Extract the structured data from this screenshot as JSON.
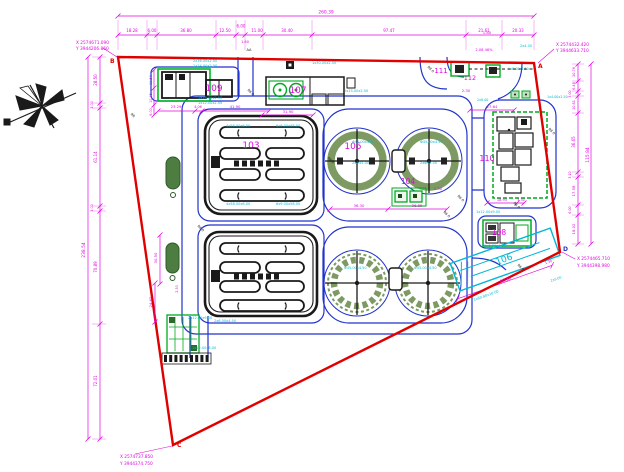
{
  "drawing_type": "wastewater treatment plant site plan (CAD)",
  "boundary": {
    "color": "#e00000",
    "corners": [
      {
        "id": "B",
        "x": "X 2574671.090",
        "y": "Y 3944206.860"
      },
      {
        "id": "A",
        "x": "X 2574432.420",
        "y": "Y 3944633.710"
      },
      {
        "id": "D",
        "x": "X 2574465.710",
        "y": "Y 3944398.980"
      },
      {
        "id": "C",
        "x": "X 2574737.850",
        "y": "Y 3944374.750"
      }
    ]
  },
  "dimension_chains": {
    "top": {
      "total": "260.39",
      "segments": [
        "18.28",
        "6.00",
        "36.80",
        "12.50",
        "6.00",
        "11.00",
        "30.40",
        "97.47",
        "21.61",
        "20.33"
      ]
    },
    "left": {
      "total": "238.54",
      "segments": [
        "28.50",
        "3.00",
        "61.14",
        "3.00",
        "70.89",
        "72.01"
      ]
    },
    "right": {
      "total": "115.84",
      "segments": [
        "10.76",
        "6.48",
        "3.00",
        "10.81",
        "36.65",
        "3.10",
        "17.58",
        "6.00",
        "18.02"
      ]
    }
  },
  "structures": [
    {
      "number": "103",
      "shape": "aeration-basin"
    },
    {
      "number": "104",
      "shape": "distribution-box"
    },
    {
      "number": "105",
      "shape": "circular-tank-pair"
    },
    {
      "number": "106",
      "shape": "inclined-structure"
    },
    {
      "number": "107",
      "shape": "building-with-blowers"
    },
    {
      "number": "108",
      "shape": "small-building"
    },
    {
      "number": "109",
      "shape": "building"
    },
    {
      "number": "110",
      "shape": "building"
    },
    {
      "number": "111",
      "shape": "gate-structure"
    },
    {
      "number": "112",
      "shape": "gate-structure"
    }
  ],
  "colors": {
    "boundary": "#e00000",
    "dimension": "#e206e2",
    "road": "#2133cc",
    "equipment_tag": "#00b8d4",
    "structure_green": "#00aa22",
    "tank_ring": "#7d9a63"
  },
  "annotations": [
    {
      "t": "109",
      "x": 214,
      "y": 91,
      "c": "m",
      "s": 9,
      "n": "building-label-109"
    },
    {
      "t": "107",
      "x": 298,
      "y": 93,
      "c": "m",
      "s": 9,
      "n": "building-label-107"
    },
    {
      "t": "103",
      "x": 251,
      "y": 148,
      "c": "m",
      "s": 9,
      "n": "building-label-103"
    },
    {
      "t": "105",
      "x": 353,
      "y": 149,
      "c": "m",
      "s": 9,
      "n": "building-label-105"
    },
    {
      "t": "104",
      "x": 408,
      "y": 184,
      "c": "m",
      "s": 7.5,
      "n": "building-label-104"
    },
    {
      "t": "110",
      "x": 487,
      "y": 161,
      "c": "m",
      "s": 8,
      "n": "building-label-110"
    },
    {
      "t": "111",
      "x": 441,
      "y": 73,
      "c": "m",
      "s": 7,
      "n": "building-label-111"
    },
    {
      "t": "112",
      "x": 470,
      "y": 80,
      "c": "m",
      "s": 6.5,
      "n": "building-label-112"
    },
    {
      "t": "108",
      "x": 499,
      "y": 235,
      "c": "m",
      "s": 7.5,
      "n": "building-label-108"
    },
    {
      "t": "106",
      "x": 505,
      "y": 262,
      "c": "c",
      "s": 9,
      "r": -19.5,
      "n": "building-label-106"
    },
    {
      "t": "260.39",
      "x": 326,
      "y": 13.5,
      "s": 4.4
    },
    {
      "t": "18.28",
      "x": 132,
      "y": 32
    },
    {
      "t": "6.00",
      "x": 152,
      "y": 32
    },
    {
      "t": "36.80",
      "x": 186,
      "y": 32
    },
    {
      "t": "12.50",
      "x": 225,
      "y": 32
    },
    {
      "t": "6.00",
      "x": 241,
      "y": 27.5
    },
    {
      "t": "11.00",
      "x": 257,
      "y": 32
    },
    {
      "t": "30.40",
      "x": 287,
      "y": 32
    },
    {
      "t": "97.47",
      "x": 389,
      "y": 32
    },
    {
      "t": "21.61",
      "x": 484,
      "y": 32
    },
    {
      "t": "20.33",
      "x": 518,
      "y": 32
    },
    {
      "t": "238.54",
      "x": 85,
      "y": 250,
      "r": -90,
      "s": 4.4
    },
    {
      "t": "28.50",
      "x": 97,
      "y": 80,
      "r": -90
    },
    {
      "t": "3.00",
      "x": 93,
      "y": 105,
      "r": -90,
      "s": 3.4
    },
    {
      "t": "61.14",
      "x": 97,
      "y": 157,
      "r": -90
    },
    {
      "t": "3.00",
      "x": 93,
      "y": 208,
      "r": -90,
      "s": 3.4
    },
    {
      "t": "70.89",
      "x": 97,
      "y": 267,
      "r": -90
    },
    {
      "t": "72.01",
      "x": 97,
      "y": 381,
      "r": -90
    },
    {
      "t": "115.84",
      "x": 589,
      "y": 155,
      "r": -90,
      "s": 4.4
    },
    {
      "t": "10.76",
      "x": 575,
      "y": 72,
      "r": -90,
      "s": 3.5
    },
    {
      "t": "6.48",
      "x": 575,
      "y": 86,
      "r": -90,
      "s": 3.5
    },
    {
      "t": "3.00",
      "x": 571,
      "y": 94,
      "r": -90,
      "s": 3.2
    },
    {
      "t": "10.81",
      "x": 575,
      "y": 105,
      "r": -90,
      "s": 3.5
    },
    {
      "t": "36.65",
      "x": 575,
      "y": 142,
      "r": -90
    },
    {
      "t": "3.10",
      "x": 571,
      "y": 175,
      "r": -90,
      "s": 3.2
    },
    {
      "t": "17.58",
      "x": 575,
      "y": 191,
      "r": -90,
      "s": 3.8
    },
    {
      "t": "6.00",
      "x": 571,
      "y": 210,
      "r": -90,
      "s": 3.2
    },
    {
      "t": "18.02",
      "x": 575,
      "y": 229,
      "r": -90,
      "s": 3.8
    },
    {
      "t": "23.29",
      "x": 176,
      "y": 108,
      "s": 3.8
    },
    {
      "t": "4.06",
      "x": 198,
      "y": 108,
      "s": 3.4
    },
    {
      "t": "41.90",
      "x": 235,
      "y": 108,
      "s": 3.8
    },
    {
      "t": "31.90",
      "x": 288,
      "y": 113,
      "s": 3.8
    },
    {
      "t": "36.30",
      "x": 359,
      "y": 207,
      "s": 3.8
    },
    {
      "t": "36.85",
      "x": 417,
      "y": 207,
      "s": 3.8
    },
    {
      "t": "27.64",
      "x": 492,
      "y": 108,
      "s": 3.8
    },
    {
      "t": "18.95",
      "x": 502,
      "y": 201,
      "s": 3.6
    },
    {
      "t": "4.30",
      "x": 521,
      "y": 201,
      "s": 3.3
    },
    {
      "t": "1.80",
      "x": 487,
      "y": 34,
      "s": 3.8
    },
    {
      "t": "2.08 46%",
      "x": 484,
      "y": 51,
      "s": 3.6
    },
    {
      "t": "2.30",
      "x": 466,
      "y": 92,
      "s": 3.8
    },
    {
      "t": "2.30",
      "x": 438,
      "y": 190,
      "s": 3.8
    },
    {
      "t": "1.60",
      "x": 245,
      "y": 43,
      "s": 3.6
    },
    {
      "t": "60.80",
      "x": 506,
      "y": 281,
      "r": -19.5,
      "s": 4.2
    },
    {
      "t": "1.30",
      "x": 549,
      "y": 263,
      "r": -19.5,
      "s": 3.4
    },
    {
      "t": "24.65",
      "x": 152,
      "y": 302,
      "r": -90,
      "s": 3.8
    },
    {
      "t": "30.50",
      "x": 157,
      "y": 258,
      "r": -90,
      "s": 3.8
    },
    {
      "t": "11.50",
      "x": 152,
      "y": 80,
      "r": -90,
      "s": 3.4
    },
    {
      "t": "10.45",
      "x": 152,
      "y": 98,
      "r": -90,
      "s": 3.4
    },
    {
      "t": "6.00",
      "x": 152,
      "y": 112,
      "r": -90,
      "s": 3.4
    },
    {
      "t": "2.50",
      "x": 178,
      "y": 289,
      "r": -90,
      "s": 3.4
    },
    {
      "t": "RR",
      "x": 132,
      "y": 116,
      "r": 45,
      "c": "k",
      "s": 3.4
    },
    {
      "t": "AA",
      "x": 249,
      "y": 51,
      "c": "k",
      "s": 3.6
    },
    {
      "t": "R6.0",
      "x": 250,
      "y": 93,
      "r": 45,
      "c": "k",
      "s": 3.4
    },
    {
      "t": "R8.0",
      "x": 430,
      "y": 70,
      "r": 45,
      "c": "k",
      "s": 3.4
    },
    {
      "t": "R6.0",
      "x": 330,
      "y": 161,
      "r": 45,
      "c": "k",
      "s": 3.4
    },
    {
      "t": "R6.0",
      "x": 460,
      "y": 199,
      "r": 45,
      "c": "k",
      "s": 3.4
    },
    {
      "t": "R6.0",
      "x": 446,
      "y": 215,
      "r": 45,
      "c": "k",
      "s": 3.4
    },
    {
      "t": "R6.0",
      "x": 200,
      "y": 229,
      "r": 45,
      "c": "k",
      "s": 3.4
    },
    {
      "t": "R6.0",
      "x": 516,
      "y": 206,
      "r": 45,
      "c": "k",
      "s": 3.4
    },
    {
      "t": "R8.0",
      "x": 551,
      "y": 132,
      "r": 45,
      "c": "k",
      "s": 3.4
    },
    {
      "t": "R6.0",
      "x": 520,
      "y": 268,
      "r": 45,
      "c": "k",
      "s": 3.4
    },
    {
      "t": "2x36.00x2.50",
      "x": 193,
      "y": 62,
      "c": "c",
      "s": 3.5,
      "a": "s"
    },
    {
      "t": "1x24.00x2.50",
      "x": 193,
      "y": 67,
      "c": "c",
      "s": 3.5,
      "a": "s"
    },
    {
      "t": "2x18.00x2.50",
      "x": 198,
      "y": 99,
      "c": "c",
      "s": 3.5,
      "a": "s"
    },
    {
      "t": "1x12.00x2.50",
      "x": 198,
      "y": 104,
      "c": "c",
      "s": 3.5,
      "a": "s"
    },
    {
      "t": "1x30.00x2.50",
      "x": 312,
      "y": 64,
      "c": "c",
      "s": 3.5,
      "a": "s"
    },
    {
      "t": "2x15.00x2.50",
      "x": 344,
      "y": 92,
      "c": "c",
      "s": 3.5,
      "a": "s"
    },
    {
      "t": "4x58.00x6.00",
      "x": 226,
      "y": 127,
      "c": "c",
      "s": 3.5,
      "a": "s"
    },
    {
      "t": "6x9.00x58.00",
      "x": 276,
      "y": 127,
      "c": "c",
      "s": 3.5,
      "a": "s"
    },
    {
      "t": "4x58.00x6.00",
      "x": 226,
      "y": 205,
      "c": "c",
      "s": 3.5,
      "a": "s"
    },
    {
      "t": "6x9.00x58.00",
      "x": 276,
      "y": 205,
      "c": "c",
      "s": 3.5,
      "a": "s"
    },
    {
      "t": "Φ45.00x4.50",
      "x": 352,
      "y": 143,
      "c": "c",
      "s": 3.5,
      "a": "s"
    },
    {
      "t": "2xΦ45.00",
      "x": 352,
      "y": 164,
      "c": "c",
      "s": 3.5,
      "a": "s"
    },
    {
      "t": "Φ45.00x4.50",
      "x": 420,
      "y": 143,
      "c": "c",
      "s": 3.5,
      "a": "s"
    },
    {
      "t": "2xΦ45.00",
      "x": 420,
      "y": 164,
      "c": "c",
      "s": 3.5,
      "a": "s"
    },
    {
      "t": "Φ45.00x4.50",
      "x": 344,
      "y": 269,
      "c": "c",
      "s": 3.5,
      "a": "s"
    },
    {
      "t": "Φ45.00x4.50",
      "x": 414,
      "y": 269,
      "c": "c",
      "s": 3.5,
      "a": "s"
    },
    {
      "t": "2x12.00x9.00",
      "x": 188,
      "y": 319,
      "c": "c",
      "s": 3.5,
      "a": "s"
    },
    {
      "t": "2x6.00x4.50",
      "x": 214,
      "y": 322,
      "c": "c",
      "s": 3.5,
      "a": "s"
    },
    {
      "t": "1x12.00x6.00",
      "x": 192,
      "y": 349,
      "c": "c",
      "s": 3.5,
      "a": "s"
    },
    {
      "t": "1x12.00x9.00",
      "x": 476,
      "y": 213,
      "c": "c",
      "s": 3.5,
      "a": "s"
    },
    {
      "t": "2x6.00x4.50",
      "x": 484,
      "y": 247,
      "c": "c",
      "s": 3.5,
      "a": "s"
    },
    {
      "t": "2x4.00",
      "x": 520,
      "y": 47,
      "c": "c",
      "s": 3.5,
      "a": "s"
    },
    {
      "t": "1x6.00x4.50",
      "x": 508,
      "y": 70,
      "c": "c",
      "s": 3.3,
      "a": "s"
    },
    {
      "t": "1x4.00x2.50",
      "x": 547,
      "y": 98,
      "c": "c",
      "s": 3.3,
      "a": "s"
    },
    {
      "t": "2x8.00",
      "x": 477,
      "y": 101,
      "c": "c",
      "s": 3.3,
      "a": "s"
    },
    {
      "t": "1x60.80x10.00",
      "x": 474,
      "y": 301,
      "c": "c",
      "s": 3.5,
      "a": "s",
      "r": -19.5
    },
    {
      "t": "2x6.00",
      "x": 551,
      "y": 282,
      "c": "c",
      "s": 3.3,
      "a": "s",
      "r": -19.5
    }
  ]
}
